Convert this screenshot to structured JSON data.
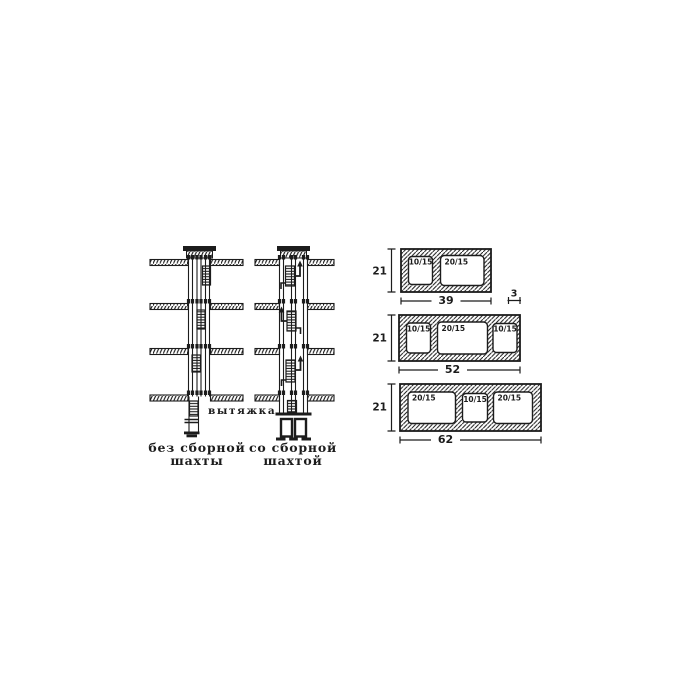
{
  "figure": {
    "type": "ventilation-shaft-and-block-sections-diagram",
    "ink_color": "#1c1c1c",
    "paper_color": "#ffffff"
  },
  "shafts": {
    "exhaust_label": "вытяжка",
    "left_caption": [
      "без сборной",
      "шахты"
    ],
    "right_caption": [
      "со сборной",
      "шахтой"
    ]
  },
  "blocks": [
    {
      "height": "21",
      "width": "39",
      "wall": "3",
      "openings": [
        "10/15",
        "20/15"
      ]
    },
    {
      "height": "21",
      "width": "52",
      "openings": [
        "10/15",
        "20/15",
        "10/15"
      ]
    },
    {
      "height": "21",
      "width": "62",
      "openings": [
        "20/15",
        "10/15",
        "20/15"
      ]
    }
  ]
}
